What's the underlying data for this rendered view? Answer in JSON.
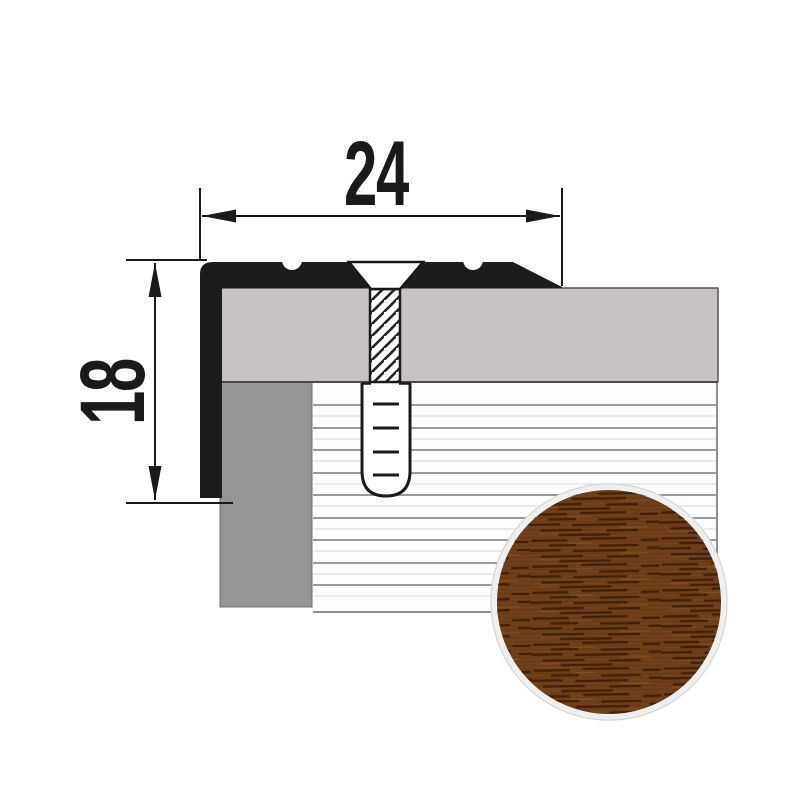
{
  "diagram": {
    "dimensions": {
      "width": {
        "label": "24"
      },
      "height": {
        "label": "18"
      }
    }
  },
  "colors": {
    "profile_black": "#1c1c1c",
    "aluminum_gray": "#c6c3c2",
    "substrate_gray": "#959595",
    "floor_white": "#fdfdfd",
    "floor_line": "#9a9a9a",
    "dimension_ink": "#1a1a1a",
    "wood_base": "#6f4019",
    "wood_grain_dark": "#3f2109",
    "wood_grain_light": "#815024",
    "swatch_ring": "#efefef",
    "background": "#ffffff"
  }
}
